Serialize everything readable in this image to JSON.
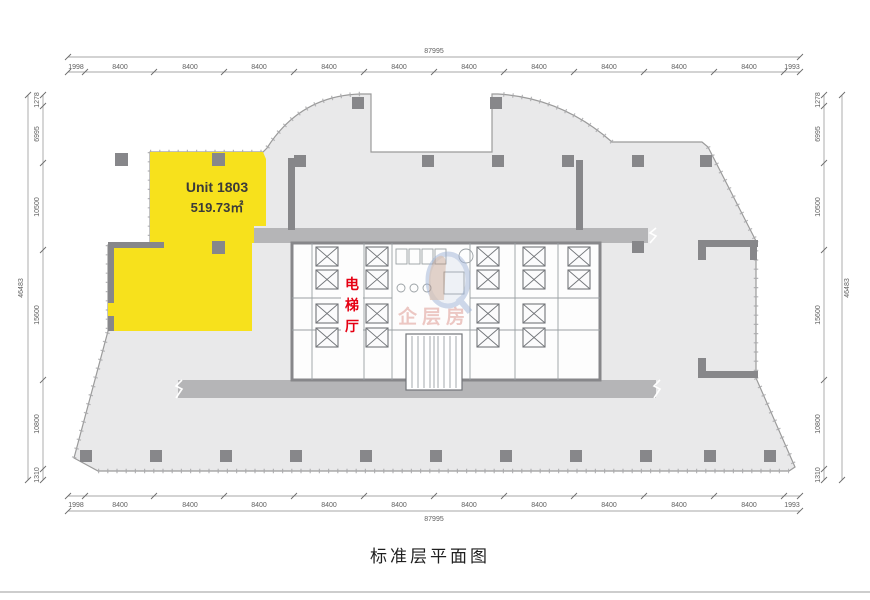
{
  "title": "标准层平面图",
  "unit": {
    "name": "Unit 1803",
    "area": "519.73㎡"
  },
  "elevator_hall": {
    "text": "电梯厅",
    "chars": [
      "电",
      "梯",
      "厅"
    ]
  },
  "watermark": {
    "text": "企层房"
  },
  "colors": {
    "unit_highlight": "#f7e11c",
    "floor": "#e9e9ea",
    "corridor": "#b5b5b7",
    "wall": "#87878a",
    "hall_text": "#e60013",
    "dimension_text": "#5f5f5f"
  },
  "dimensions": {
    "top": {
      "overall": "87995",
      "segments": [
        "1998",
        "8400",
        "8400",
        "8400",
        "8400",
        "8400",
        "8400",
        "8400",
        "8400",
        "8400",
        "8400",
        "1993"
      ]
    },
    "bottom": {
      "overall": "87995",
      "segments": [
        "1998",
        "8400",
        "8400",
        "8400",
        "8400",
        "8400",
        "8400",
        "8400",
        "8400",
        "8400",
        "8400",
        "1993"
      ]
    },
    "left": {
      "overall": "46483",
      "segments": [
        "1278",
        "6995",
        "10500",
        "15600",
        "10800",
        "1310"
      ]
    },
    "right": {
      "overall": "46483",
      "segments": [
        "1278",
        "6995",
        "10500",
        "15600",
        "10800",
        "1310"
      ]
    }
  }
}
